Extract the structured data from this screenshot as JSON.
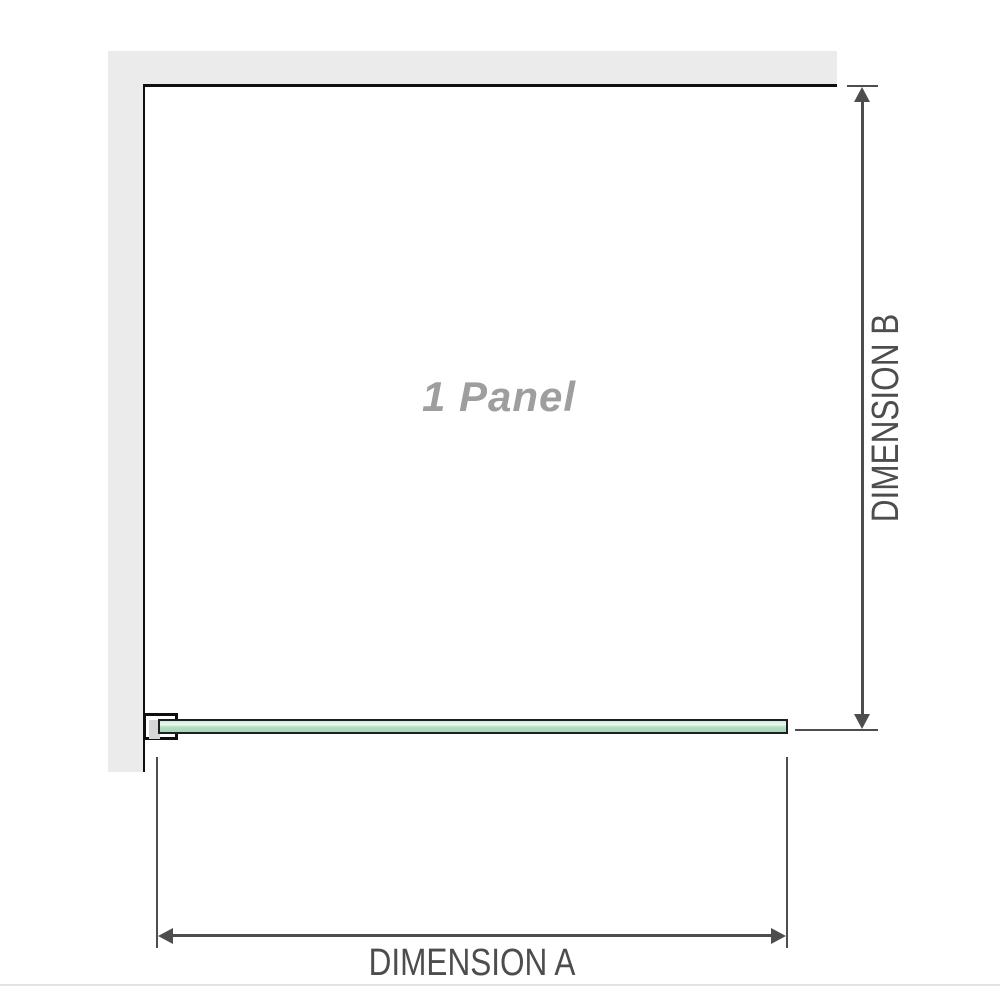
{
  "diagram": {
    "panel_label": "1 Panel",
    "dimension_a_label": "DIMENSION A",
    "dimension_b_label": "DIMENSION B"
  },
  "colors": {
    "wall_gray": "#ebebeb",
    "wall_line": "#0f0f0f",
    "dim_color": "#4d4d4d",
    "panel_label_gray": "#9e9e9e",
    "glass_outline": "#1f1f1f",
    "glass_green": "#b0ddc0",
    "bracket_inner": "#d6d6d6",
    "baseline_gray": "#e3e3e3"
  }
}
